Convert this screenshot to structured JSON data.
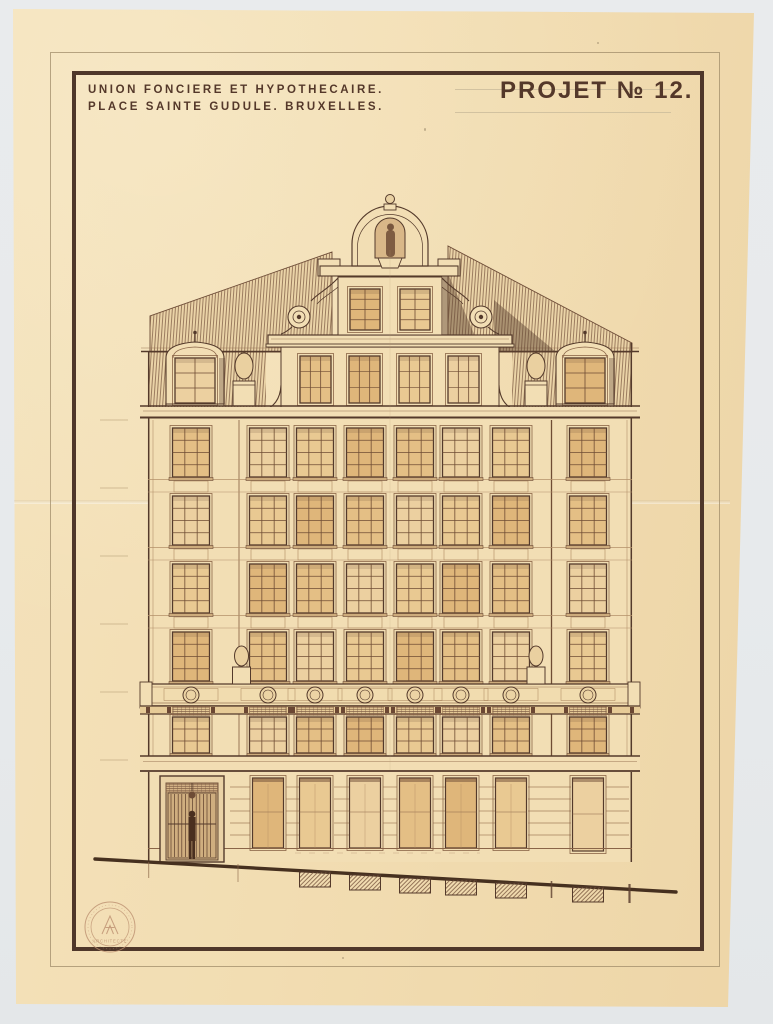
{
  "header": {
    "line1": "UNION FONCIERE ET HYPOTHECAIRE.",
    "line2": "PLACE SAINTE GUDULE. BRUXELLES.",
    "projet": "PROJET  № 12."
  },
  "stamp": {
    "bottom_text": "ARCHITECTE"
  },
  "palette": {
    "backdrop": "#e9ebed",
    "paper": "#f2ddb2",
    "wall": "#f2deb4",
    "ink": "#543a2b",
    "ink_light": "#8a6548",
    "frame": "#4f372a",
    "glazing": "#e4bf85",
    "glazing_light": "#ecd0a0",
    "hatch": "#7c5a42",
    "shadow": "#5e4230",
    "stamp_ink": "#bb8f6f"
  },
  "drawing": {
    "wall": {
      "x": 148,
      "y": 417,
      "w": 484,
      "h": 445
    },
    "columns": [
      191,
      268,
      315,
      365,
      415,
      461,
      511,
      588
    ],
    "window_w": 37,
    "upper_rows_y": [
      428,
      496,
      564,
      632
    ],
    "upper_row_h": 49,
    "band_ys": [
      479,
      547,
      615
    ],
    "entresol": {
      "y": 717,
      "h": 36,
      "grille_h": 9
    },
    "balustrade": {
      "y": 684,
      "h": 22,
      "medallion_r": 8,
      "finials_cx": [
        241.5,
        536
      ]
    },
    "attic_finials_cx": [
      244,
      536
    ],
    "dormers_cx": [
      195,
      585
    ],
    "pilasters_x": [
      239,
      551.5
    ],
    "gable": {
      "axis": 390,
      "arch": {
        "x1": 352,
        "x2": 428,
        "base_y": 266,
        "r": 38
      },
      "orb": {
        "cx": 390,
        "cy": 199,
        "r": 4.5
      },
      "shoulder": {
        "x": 320,
        "y": 266,
        "w": 138,
        "h": 10
      },
      "niche": {
        "x": 375,
        "y": 218,
        "w": 30,
        "h": 40
      },
      "upper_wall": {
        "x": 338,
        "y": 277,
        "w": 104,
        "h": 58
      },
      "upper_windows_x": [
        350,
        400
      ],
      "upper_win": {
        "y": 289,
        "w": 30,
        "h": 41
      },
      "cornice2": {
        "x": 268,
        "y": 335,
        "w": 244,
        "h": 12
      },
      "lower_wall": {
        "x": 281,
        "y": 347,
        "w": 218,
        "h": 64
      },
      "lower_windows_x": [
        300,
        349,
        399,
        448
      ],
      "lower_win": {
        "y": 356,
        "w": 31,
        "h": 47
      },
      "volutes_cx": [
        299,
        481
      ],
      "volute_cy": 317
    },
    "roof": {
      "left_poly": "150,352 150,316 332,252 332,352",
      "right_poly": "448,352 448,246 632,343 632,352",
      "mansard_left": {
        "x": 148,
        "y": 352,
        "w": 118,
        "h": 56
      },
      "mansard_right": {
        "x": 512,
        "y": 352,
        "w": 120,
        "h": 56
      },
      "eaves_y": 351.5
    },
    "cornice_main": {
      "x": 140,
      "y": 406,
      "w": 500,
      "h": 12
    },
    "beam": {
      "y": 706,
      "h": 8
    },
    "architrave": {
      "x": 140,
      "y": 756,
      "w": 500,
      "h": 16
    },
    "ground": {
      "openings_cx": [
        268,
        315,
        365,
        415,
        461,
        511
      ],
      "opening": {
        "y": 778,
        "w": 31,
        "h": 70
      },
      "right_opening": {
        "x": 572.5,
        "y": 778,
        "w": 31,
        "h": 73
      },
      "door": {
        "x": 160,
        "y": 776,
        "w": 64,
        "h": 86
      },
      "pier_groove_segments": [
        [
          230,
          250
        ],
        [
          286,
          299
        ],
        [
          334,
          349
        ],
        [
          383,
          397
        ],
        [
          433,
          445
        ],
        [
          479,
          495
        ],
        [
          528,
          571
        ],
        [
          606,
          629
        ]
      ],
      "groove_ys": [
        787,
        799,
        811,
        823,
        835
      ]
    },
    "ground_line": {
      "x1": 95,
      "y1": 859,
      "x2": 676,
      "y2": 892
    },
    "basement": [
      [
        299.5,
        871
      ],
      [
        349.5,
        874
      ],
      [
        399.5,
        877
      ],
      [
        445.5,
        879
      ],
      [
        495.5,
        882
      ],
      [
        572.5,
        886
      ]
    ],
    "basement_w": 31,
    "basement_h": 15,
    "level_ticks_y": [
      420,
      488,
      556,
      624,
      692,
      760
    ],
    "stamp": {
      "cx": 110,
      "cy": 927,
      "r_outer": 25,
      "r_inner": 19
    }
  }
}
